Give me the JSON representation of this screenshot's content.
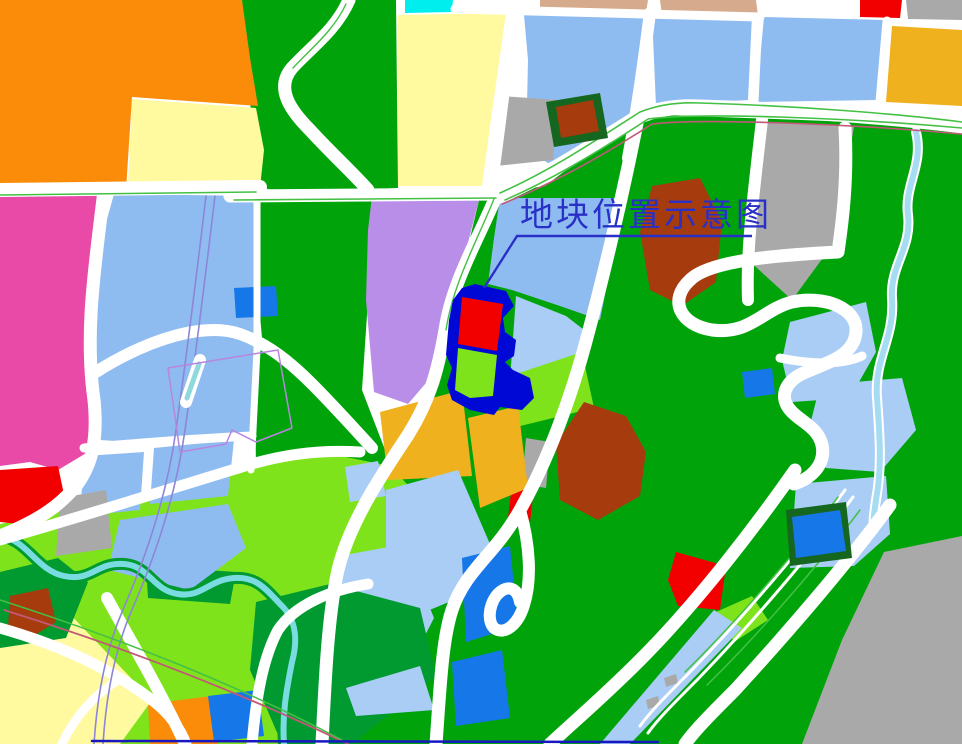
{
  "title": {
    "label": "地块位置示意图"
  },
  "colors": {
    "road": "#FFFFFF",
    "green": "#00A40A",
    "green_dark": "#009A30",
    "chartreuse": "#7FE31C",
    "blue_light": "#8FBCF0",
    "blue_lighter": "#A9CDF5",
    "blue_med": "#1677E8",
    "cyan": "#00EEEE",
    "orange": "#FA8C0A",
    "amber": "#EFB11E",
    "pale_yellow": "#FFF9A0",
    "magenta": "#E94AA8",
    "purple": "#B98EE8",
    "red": "#F20000",
    "brown_red": "#A63C0E",
    "tan": "#D6AA8C",
    "gray": "#A9A9A9",
    "navy": "#0008D6",
    "title_blue": "#2830C8",
    "river": "#7ADCE0",
    "stream": "#A5DCF2",
    "accent_green": "#44C044",
    "accent_crimson": "#C25878",
    "accent_purple": "#8C86D8",
    "accent_violet": "#B884E0",
    "dark_border_green": "#15661E",
    "bottom_line": "#1818C0"
  },
  "map": {
    "width": 962,
    "height": 744,
    "base": [
      {
        "name": "greenbelt-strip-top",
        "points": "242,0 396,0 398,188 300,193 258,188 246,58",
        "fill": "green"
      },
      {
        "name": "greenbelt-center-left",
        "points": "258,194 376,194 368,300 362,390 392,468 386,508 330,542 274,520 256,470 254,300",
        "fill": "green"
      },
      {
        "name": "greenbelt-right",
        "points": "480,196 545,186 640,114 962,126 962,744 316,744 330,640 354,558 386,494 420,430 446,344 458,278 470,238",
        "fill": "green"
      },
      {
        "name": "greenspace-bottom-left",
        "points": "0,524 118,500 236,464 312,450 390,466 422,500 400,560 370,640 344,744 0,744",
        "fill": "chartreuse"
      }
    ],
    "parcels": [
      {
        "name": "parcel-orange-topleft",
        "points": "0,0 242,0 250,58 258,106 132,97 126,190 0,190",
        "fill": "orange"
      },
      {
        "name": "parcel-yellow-topleft",
        "points": "132,99 256,108 264,150 260,188 128,188",
        "fill": "pale_yellow"
      },
      {
        "name": "parcel-magenta",
        "points": "0,194 102,192 96,260 86,330 97,400 88,452 58,470 30,462 0,466",
        "fill": "magenta"
      },
      {
        "name": "parcel-lightblue-centerleft",
        "points": "114,194 256,196 258,300 252,408 250,438 160,444 100,440 86,360 98,280 104,230",
        "fill": "blue_light"
      },
      {
        "name": "parcel-cyan-top",
        "points": "405,0 453,0 452,12 405,13",
        "fill": "cyan"
      },
      {
        "name": "parcel-yellow-topcenter",
        "points": "398,15 506,13 492,112 482,186 398,186",
        "fill": "pale_yellow"
      },
      {
        "name": "parcel-tan-1",
        "points": "540,0 648,0 646,13 540,14",
        "fill": "tan"
      },
      {
        "name": "parcel-tan-2",
        "points": "660,0 756,0 758,16 662,15",
        "fill": "tan"
      },
      {
        "name": "parcel-red-topright",
        "points": "860,0 902,0 900,18 860,17",
        "fill": "red"
      },
      {
        "name": "parcel-gray-topright",
        "points": "906,0 962,0 962,20 908,19",
        "fill": "gray"
      },
      {
        "name": "parcel-lightblue-top-c",
        "points": "524,15 644,13 630,118 600,150 560,170 526,150 528,60",
        "fill": "blue_light"
      },
      {
        "name": "parcel-gray-topcenter",
        "points": "500,96 558,100 553,160 496,166",
        "fill": "gray"
      },
      {
        "name": "parcel-lightblue-top-a",
        "points": "652,14 752,15 748,100 656,106",
        "fill": "blue_light"
      },
      {
        "name": "parcel-lightblue-top-b",
        "points": "764,17 884,20 878,100 756,102",
        "fill": "blue_light"
      },
      {
        "name": "parcel-amber-topright",
        "points": "892,26 962,30 962,106 886,102",
        "fill": "amber"
      },
      {
        "name": "parcel-gray-midright",
        "points": "764,122 854,126 836,240 792,300 746,258 756,175",
        "fill": "gray"
      },
      {
        "name": "parcel-purple",
        "points": "372,196 480,196 462,266 444,325 432,376 408,404 374,392 366,300 368,230",
        "fill": "purple"
      },
      {
        "name": "parcel-lightblue-above-site",
        "points": "500,198 624,198 600,320 560,306 512,290 488,284 494,238",
        "fill": "blue_light"
      },
      {
        "name": "parcel-lightblue-right-of-site",
        "points": "516,296 566,316 592,336 580,388 510,380",
        "fill": "blue_lighter"
      },
      {
        "name": "parcel-green-se-of-site",
        "points": "504,378 582,352 594,408 512,428",
        "fill": "chartreuse"
      },
      {
        "name": "parcel-rust-centerright",
        "points": "652,186 700,178 722,222 716,282 682,306 650,290 640,232",
        "fill": "brown_red"
      },
      {
        "name": "parcel-rust-central",
        "points": "584,402 626,416 646,452 640,496 598,520 560,500 556,444",
        "fill": "brown_red"
      },
      {
        "name": "parcel-gray-small-central",
        "points": "526,438 550,442 546,488 522,484",
        "fill": "gray"
      },
      {
        "name": "parcel-red-small-central",
        "points": "512,484 534,488 530,522 508,518",
        "fill": "red"
      },
      {
        "name": "parcel-amber-left",
        "points": "380,412 462,390 472,476 388,480",
        "fill": "amber"
      },
      {
        "name": "parcel-amber-right",
        "points": "468,418 518,406 528,488 480,508",
        "fill": "amber"
      },
      {
        "name": "parcel-lightblue-d",
        "points": "345,467 378,461 386,496 350,502",
        "fill": "blue_lighter"
      },
      {
        "name": "parcel-lightblue-e",
        "points": "386,490 458,470 490,544 468,594 420,614 386,568",
        "fill": "blue_lighter"
      },
      {
        "name": "parcel-lightblue-f",
        "points": "340,556 404,544 434,618 396,692 344,706 330,640 332,580",
        "fill": "blue_lighter"
      },
      {
        "name": "parcel-blue-b1",
        "points": "462,558 510,546 518,626 466,642",
        "fill": "blue_med"
      },
      {
        "name": "parcel-blue-b2",
        "points": "452,662 502,650 510,718 456,726",
        "fill": "blue_med"
      },
      {
        "name": "forest-bottom-center",
        "points": "256,602 330,584 420,608 436,676 352,744 282,744 250,670",
        "fill": "green_dark"
      },
      {
        "name": "parcel-lightblue-triangle",
        "points": "346,688 420,666 434,710 356,716",
        "fill": "blue_lighter"
      },
      {
        "name": "parcel-orange-bottom",
        "points": "148,704 212,696 218,744 150,744",
        "fill": "orange"
      },
      {
        "name": "parcel-blue-bottom",
        "points": "208,696 258,690 264,736 214,742",
        "fill": "blue_med"
      },
      {
        "name": "parcel-yellow-bottomleft",
        "points": "0,624 66,610 152,700 120,744 0,744",
        "fill": "pale_yellow"
      },
      {
        "name": "forest-patch-left",
        "points": "0,572 58,558 88,582 66,638 0,648",
        "fill": "green_dark"
      },
      {
        "name": "parcel-rust-bottomleft",
        "points": "10,596 48,588 56,622 30,638 8,628",
        "fill": "brown_red"
      },
      {
        "name": "forest-patch-riverbank",
        "points": "146,566 236,572 230,604 148,598",
        "fill": "green_dark"
      },
      {
        "name": "parcel-lightblue-bl1",
        "points": "84,456 144,452 140,510 80,516",
        "fill": "blue_light"
      },
      {
        "name": "parcel-lightblue-bl2",
        "points": "154,448 234,440 228,496 150,504",
        "fill": "blue_light"
      },
      {
        "name": "parcel-red-bottomleft",
        "points": "0,470 58,466 66,504 38,526 0,522",
        "fill": "red"
      },
      {
        "name": "parcel-gray-bottomleft",
        "points": "60,498 106,490 112,548 56,556",
        "fill": "gray"
      },
      {
        "name": "parcel-lightblue-bl3",
        "points": "120,520 228,504 246,548 190,590 108,570",
        "fill": "blue_light"
      },
      {
        "name": "parcel-gray-bottomright",
        "points": "884,552 962,536 962,744 802,744 842,640",
        "fill": "gray"
      },
      {
        "name": "parcel-lightblue-i",
        "points": "796,484 886,476 890,534 854,566 790,568",
        "fill": "blue_lighter"
      },
      {
        "name": "parcel-lightblue-j",
        "points": "790,322 866,302 876,352 850,398 792,402 782,360",
        "fill": "blue_lighter"
      },
      {
        "name": "parcel-lightblue-k",
        "points": "820,385 902,378 916,430 880,472 826,468 810,425",
        "fill": "blue_lighter"
      },
      {
        "name": "parcel-red-b",
        "points": "676,552 726,566 720,610 678,606 668,580",
        "fill": "red"
      },
      {
        "name": "parcel-green-br",
        "points": "716,612 752,596 768,620 734,642",
        "fill": "chartreuse"
      },
      {
        "name": "parcel-lightblue-strip",
        "points": "600,744 714,610 742,628 630,744",
        "fill": "blue_lighter"
      },
      {
        "name": "building-gray-1",
        "points": "646,700 658,696 660,705 648,709",
        "fill": "gray"
      },
      {
        "name": "building-gray-2",
        "points": "664,678 676,674 678,683 666,687",
        "fill": "gray"
      },
      {
        "name": "parcel-blue-mid",
        "points": "234,288 276,286 278,316 236,318",
        "fill": "blue_med"
      },
      {
        "name": "parcel-blue-b3",
        "points": "742,372 772,368 775,394 745,398",
        "fill": "blue_med"
      }
    ],
    "rivers": [
      {
        "name": "river-bl-casing",
        "d": "M0,536 C28,540 36,570 64,576 C92,582 96,562 124,564 C150,566 152,590 178,594 C202,598 208,580 234,578 C258,576 268,592 282,606 C296,620 298,640 292,662 C286,692 282,716 284,744",
        "stroke": "green_dark",
        "w": 12
      },
      {
        "name": "river-bl-water",
        "d": "M0,536 C28,540 36,570 64,576 C92,582 96,562 124,564 C150,566 152,590 178,594 C202,598 208,580 234,578 C258,576 268,592 282,606 C296,620 298,640 292,662 C286,692 282,716 284,744",
        "stroke": "river",
        "w": 6
      },
      {
        "name": "stream-right-casing",
        "d": "M916,132 C924,165 904,185 908,215 C912,248 890,265 892,298 C895,338 874,358 877,398 C880,438 882,468 876,500 C874,514 873,520 874,528",
        "stroke": "road",
        "w": 10
      },
      {
        "name": "stream-right-water",
        "d": "M916,132 C924,165 904,185 908,215 C912,248 890,265 892,298 C895,338 874,358 877,398 C880,438 882,468 876,500 C874,514 873,520 874,528",
        "stroke": "stream",
        "w": 6
      }
    ],
    "roads": [
      {
        "name": "road-left-horizontal",
        "d": "M0,190 L260,187",
        "stroke": "road",
        "w": 14
      },
      {
        "name": "road-center-horizontal",
        "d": "M230,196 L500,194",
        "stroke": "road",
        "w": 13
      },
      {
        "name": "road-right-horizontal",
        "d": "M500,196 C555,172 600,140 640,116 C660,108 680,106 700,107 C800,110 900,118 962,126",
        "stroke": "road",
        "w": 15
      },
      {
        "name": "road-top-horizontal",
        "d": "M455,9 L760,17",
        "stroke": "road",
        "w": 9
      },
      {
        "name": "road-left-vertical",
        "d": "M104,190 C96,260 84,330 94,400 C98,440 92,465 76,486 C60,505 40,520 0,536",
        "stroke": "road",
        "w": 13
      },
      {
        "name": "road-greenstrip-winding",
        "d": "M349,0 C336,30 310,48 292,68 C275,88 290,110 310,130 C330,152 352,172 368,190",
        "stroke": "road",
        "w": 13
      },
      {
        "name": "road-main-diagonal",
        "d": "M497,194 C478,240 452,282 445,330 C438,370 430,400 408,435 C385,470 350,520 338,570 C328,615 325,680 322,744",
        "stroke": "road",
        "w": 13
      },
      {
        "name": "road-lightblue-boundary",
        "d": "M257,196 L257,350 L251,470",
        "stroke": "road",
        "w": 7
      },
      {
        "name": "road-s-curve-left",
        "d": "M96,372 C150,338 205,322 240,334 C268,344 290,362 312,384 C332,404 352,426 372,448",
        "stroke": "road",
        "w": 12
      },
      {
        "name": "road-stem-blue-mid",
        "d": "M257,316 L259,338",
        "stroke": "road",
        "w": 6
      },
      {
        "name": "road-x650",
        "d": "M650,13 C644,60 636,115 628,158",
        "stroke": "road",
        "w": 12
      },
      {
        "name": "road-x757",
        "d": "M758,17 L754,102",
        "stroke": "road",
        "w": 9
      },
      {
        "name": "road-x885",
        "d": "M887,21 L880,102",
        "stroke": "road",
        "w": 9
      },
      {
        "name": "road-x512",
        "d": "M514,13 C508,70 500,130 492,190",
        "stroke": "road",
        "w": 10
      },
      {
        "name": "road-5-south",
        "d": "M638,118 C622,200 600,290 585,345 C570,400 548,460 520,510 C495,555 465,570 452,610 C442,640 440,690 436,744",
        "stroke": "road",
        "w": 13
      },
      {
        "name": "road-5-hairpin",
        "d": "M520,510 C530,545 532,580 524,605 C518,625 504,636 494,628 C486,620 490,600 500,592 C510,584 518,590 520,602",
        "stroke": "road",
        "w": 12
      },
      {
        "name": "road-gray-left-edge",
        "d": "M762,120 C754,190 746,250 748,300",
        "stroke": "road",
        "w": 12
      },
      {
        "name": "road-s-right",
        "d": "M845,128 C848,180 842,225 838,252 C780,255 710,260 690,280 C668,300 680,325 712,330 C750,335 762,310 792,302 C824,295 858,308 856,332 C854,356 828,362 806,372 C784,381 778,398 792,412 C803,423 818,428 822,445 C826,464 812,478 794,484",
        "stroke": "road",
        "w": 13
      },
      {
        "name": "road-lbj-divider",
        "d": "M780,358 C810,364 840,366 862,356",
        "stroke": "road",
        "w": 9
      },
      {
        "name": "road-highway-1",
        "d": "M795,470 C760,520 700,600 640,660 C600,700 570,725 550,744",
        "stroke": "road",
        "w": 13
      },
      {
        "name": "road-highway-2",
        "d": "M890,505 C850,560 790,630 735,690 C710,715 695,730 685,744",
        "stroke": "road",
        "w": 13
      },
      {
        "name": "road-highway-inner1",
        "d": "M845,490 C805,545 745,615 690,672 C665,697 650,712 640,726",
        "stroke": "road",
        "w": 3
      },
      {
        "name": "road-highway-inner2",
        "d": "M853,497 C813,552 753,622 698,679 C673,704 658,719 648,733",
        "stroke": "road",
        "w": 3
      },
      {
        "name": "road-bl-diagonal",
        "d": "M0,540 C90,514 180,486 245,466 C290,452 330,450 360,452",
        "stroke": "road",
        "w": 11
      },
      {
        "name": "road-bl-row",
        "d": "M84,448 C150,442 210,438 252,436",
        "stroke": "road",
        "w": 9
      },
      {
        "name": "road-bl-south",
        "d": "M107,598 C130,640 160,690 185,744",
        "stroke": "road",
        "w": 12
      },
      {
        "name": "road-bl-yellow",
        "d": "M0,628 C60,645 110,668 152,700 C170,714 180,728 186,744",
        "stroke": "road",
        "w": 11
      },
      {
        "name": "road-bl-yellow-div",
        "d": "M62,744 C76,714 96,694 118,680",
        "stroke": "road",
        "w": 9
      },
      {
        "name": "road-bottom-center",
        "d": "M252,744 C256,700 262,660 278,630 C295,605 330,590 368,584",
        "stroke": "road",
        "w": 11
      }
    ],
    "accents": [
      {
        "name": "median-left",
        "d": "M0,195 L256,192",
        "stroke": "accent_green",
        "w": 1.6
      },
      {
        "name": "median-center",
        "d": "M234,200 L496,198",
        "stroke": "accent_green",
        "w": 1.6
      },
      {
        "name": "median-right-a",
        "d": "M505,200 C560,176 612,143 648,119 C700,112 850,118 962,128",
        "stroke": "accent_green",
        "w": 1.6
      },
      {
        "name": "median-right-b",
        "d": "M500,193 C556,168 602,136 640,112 C660,104 680,102 700,103 C800,106 900,114 962,122",
        "stroke": "accent_green",
        "w": 1.6
      },
      {
        "name": "railline-right",
        "d": "M502,204 C562,180 615,148 652,124 C702,118 852,124 962,134",
        "stroke": "accent_crimson",
        "w": 1.6
      },
      {
        "name": "metro-line-1",
        "d": "M206,196 C196,280 186,360 176,430 C168,488 150,548 122,612 C105,652 97,698 94,744",
        "stroke": "accent_purple",
        "w": 1.6
      },
      {
        "name": "metro-line-2",
        "d": "M215,196 C205,280 195,360 185,430 C177,488 159,548 131,612 C114,652 106,698 103,744",
        "stroke": "accent_purple",
        "w": 1.6
      },
      {
        "name": "station-pill",
        "d": "M186,402 L200,360",
        "stroke": "road",
        "w": 12
      },
      {
        "name": "station-core",
        "d": "M187,398 L199,364",
        "stroke": "#8FD8DC",
        "w": 5
      },
      {
        "name": "depot-outline",
        "d": "M168,368 L278,350 L292,428 L256,442 L232,430 L226,444 L180,452 Z",
        "stroke": "accent_violet",
        "w": 1.5
      },
      {
        "name": "railline-bl",
        "d": "M4,610 C120,646 235,690 348,744",
        "stroke": "accent_crimson",
        "w": 1.8
      },
      {
        "name": "greenline-bl",
        "d": "M0,600 C118,638 232,682 342,740",
        "stroke": "accent_green",
        "w": 1.5
      },
      {
        "name": "greenline-hw1",
        "d": "M838,497 C798,550 740,618 685,672",
        "stroke": "accent_green",
        "w": 1.5
      },
      {
        "name": "greenline-hw2",
        "d": "M860,510 C820,563 762,631 707,685",
        "stroke": "accent_green",
        "w": 1.5
      },
      {
        "name": "greenline-diag",
        "d": "M494,199 C476,243 453,284 446,330",
        "stroke": "accent_green",
        "w": 1.4
      },
      {
        "name": "greenline-strip",
        "d": "M346,4 C333,32 309,50 293,68",
        "stroke": "accent_green",
        "w": 1.4
      },
      {
        "name": "boundary-bottom-line",
        "d": "M92,741 L658,742",
        "stroke": "bottom_line",
        "w": 2.5
      }
    ],
    "landmarks": [
      {
        "name": "school-border",
        "points": "546,102 600,93 608,138 554,147",
        "fill": "dark_border_green"
      },
      {
        "name": "school-building",
        "points": "556,107 593,100 599,131 561,138",
        "fill": "brown_red"
      },
      {
        "name": "utility-parcel-border",
        "points": "786,510 846,502 852,558 790,566",
        "fill": "dark_border_green"
      },
      {
        "name": "utility-parcel-fill",
        "points": "792,517 840,510 846,551 796,558",
        "fill": "blue_med"
      }
    ],
    "highlight": {
      "outline": {
        "name": "site-outline",
        "points": "475,284 506,291 514,306 503,318 505,332 516,340 514,356 505,362 513,370 530,378 534,398 522,410 500,407 494,415 470,410 452,400 447,385 452,368 446,355 449,320 453,300 462,288",
        "fill": "navy"
      },
      "sections": [
        {
          "name": "site-red-zone",
          "points": "462,297 503,304 497,351 458,344",
          "fill": "red"
        },
        {
          "name": "site-green-zone",
          "points": "458,348 497,355 493,396 470,398 455,390",
          "fill": "chartreuse"
        }
      ]
    },
    "callout": {
      "label_x": 520,
      "label_y": 226,
      "font_size": 33,
      "underline": "M516,236 L752,236",
      "leader": "M517,236 L484,288",
      "stroke": "title_blue",
      "w": 2.4
    }
  }
}
